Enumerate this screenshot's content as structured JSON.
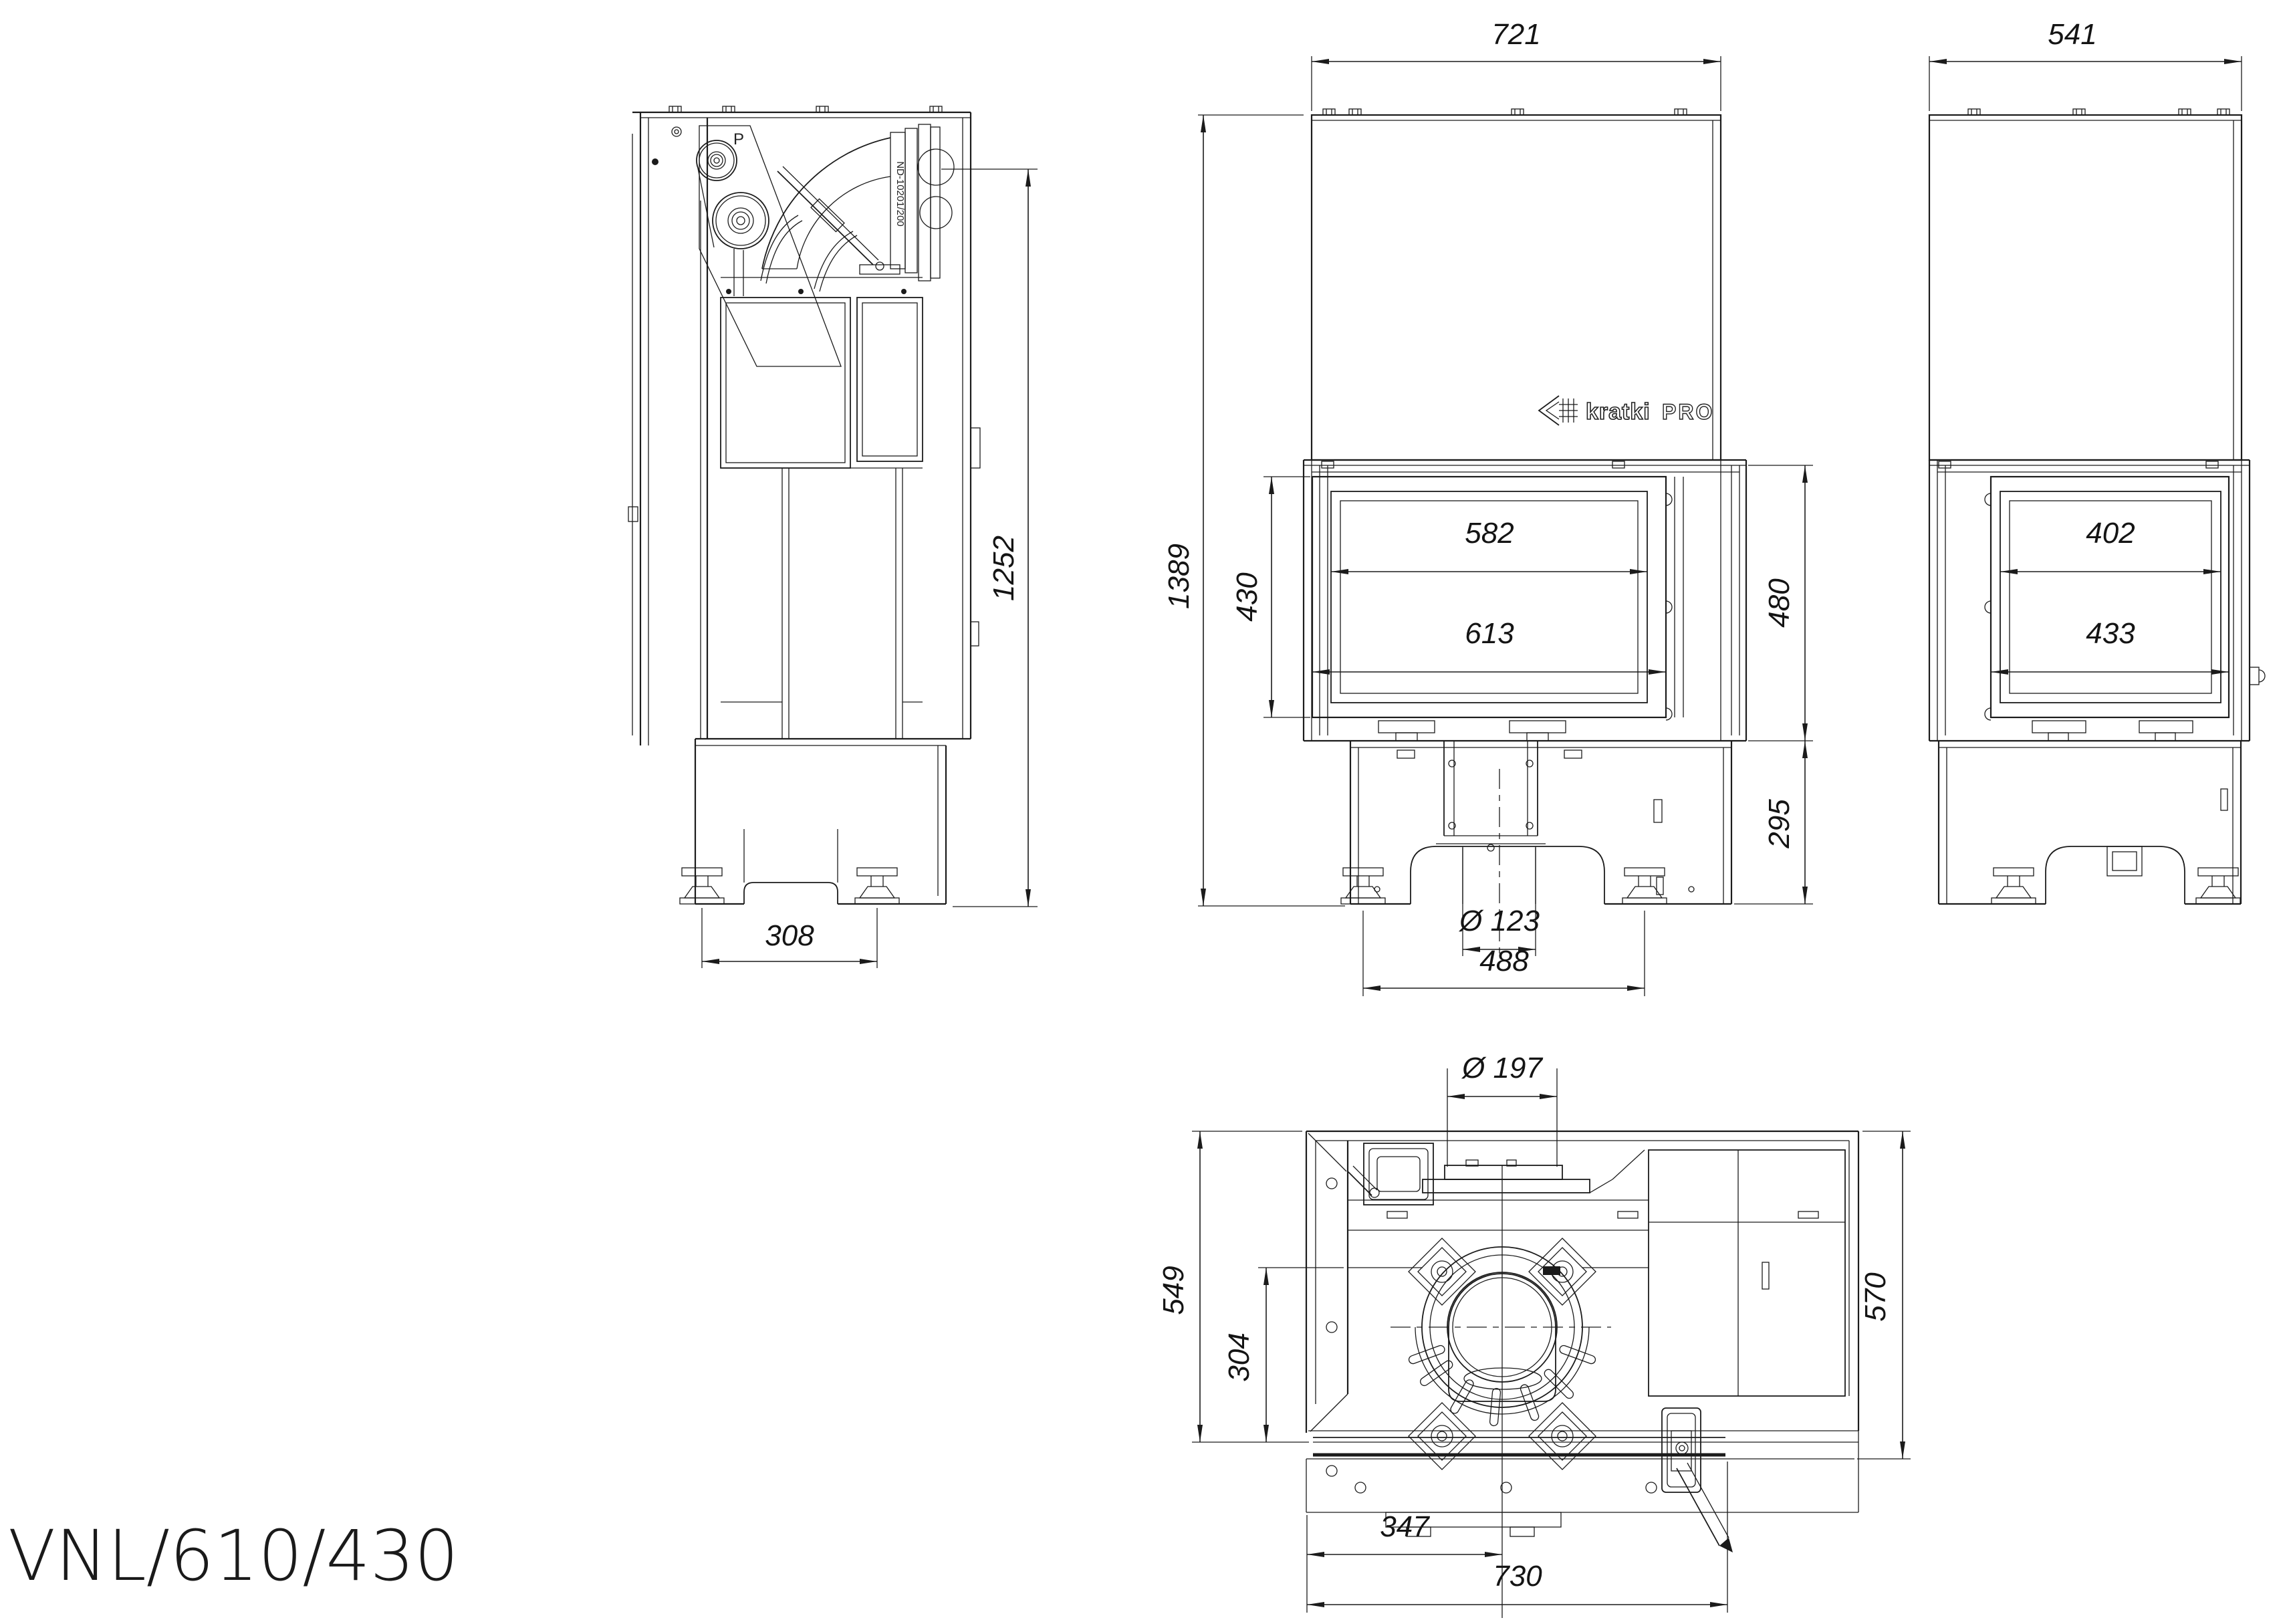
{
  "product": {
    "title": "VNL/610/430"
  },
  "brand": {
    "icon": "kratki-arrow-grid-icon",
    "name": "kratki",
    "series": "PRO"
  },
  "views": {
    "side": {
      "duct_code": "ND-10201/200",
      "pulley_mark": "P",
      "dim_height_to_duct": "1252",
      "dim_feet_spacing": "308"
    },
    "front": {
      "dim_hood_width": "721",
      "dim_overall_height": "1389",
      "dim_glass_height": "430",
      "dim_glass_width": "582",
      "dim_door_width": "613",
      "dim_firebox_section_height": "480",
      "dim_base_height": "295",
      "dim_flue_stub_diameter": "Ø 123",
      "dim_feet_spacing": "488"
    },
    "right": {
      "dim_hood_width": "541",
      "dim_side_glass_width": "402",
      "dim_side_door_width": "433"
    },
    "top": {
      "dim_collar_diameter": "Ø 197",
      "dim_depth_to_glass": "549",
      "dim_inner_depth": "304",
      "dim_overall_depth": "570",
      "dim_flue_center_offset": "347",
      "dim_overall_width": "730"
    }
  }
}
